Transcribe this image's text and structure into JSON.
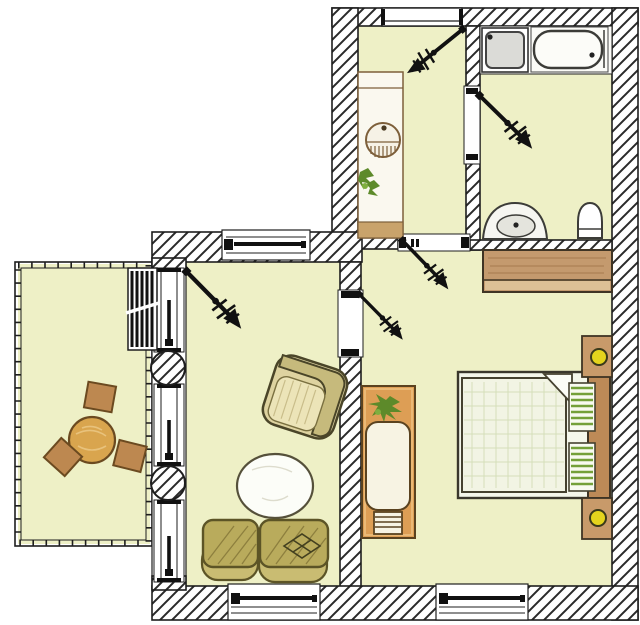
{
  "scene": {
    "type": "apartment floor plan",
    "style": "hand-drawn colored architectural sketch, no text labels",
    "door_swing_count": 5,
    "round_column_count": 2,
    "window_count": 7
  },
  "palette": {
    "background": "#ffffff",
    "floor": "#eef0c6",
    "wall_line": "#1e1e1e",
    "hatch": "#2a2a2a",
    "wood_light": "#d9a54e",
    "wood_mid": "#bd8850",
    "wood_dark": "#6b4a20",
    "wardrobe_top": "#c49a6e",
    "wardrobe_bottom": "#dcc096",
    "headboard": "#bd8a57",
    "nightstand": "#c89a6a",
    "lamp": "#e4d41d",
    "pillow_stripe": "#74a039",
    "duvet": "#f2f4e4",
    "sofa": "#b9ab5c",
    "sofa_back": "#c9bc72",
    "sofa_line": "#5c5426",
    "armchair_seat": "#ece4b8",
    "armchair_back": "#c6ba7c",
    "table_white": "#fcfdf8",
    "chaise_orange": "#dd9e55",
    "plant": "#5d8a2a",
    "fixture_white": "#fbfbf7",
    "shower_grey": "#dbdbd7",
    "radiator": "#111111"
  },
  "rooms": {
    "kitchen": {
      "fixtures": [
        "counter",
        "round-sink",
        "potted-plant"
      ],
      "openings": [
        "top-window",
        "door-swing"
      ]
    },
    "bathroom": {
      "fixtures": [
        "shower-tray",
        "bathtub",
        "wash-basin",
        "toilet"
      ],
      "openings": [
        "door-swing"
      ]
    },
    "living_room": {
      "furniture": [
        "armchair",
        "oval-coffee-table",
        "two-seat-sofa"
      ],
      "openings": [
        "top-window",
        "bottom-window",
        "door-swing",
        "glazed-balcony-wall"
      ]
    },
    "bedroom": {
      "furniture": [
        "wardrobe",
        "double-bed",
        "nightstand-with-lamp",
        "nightstand-with-lamp",
        "chaise-with-plant",
        "step-ladder"
      ],
      "openings": [
        "bottom-window",
        "door-swing",
        "door-swing"
      ]
    },
    "balcony": {
      "furniture": [
        "round-table",
        "stool",
        "stool",
        "stool",
        "radiator"
      ],
      "openings": [
        "railing"
      ]
    }
  }
}
